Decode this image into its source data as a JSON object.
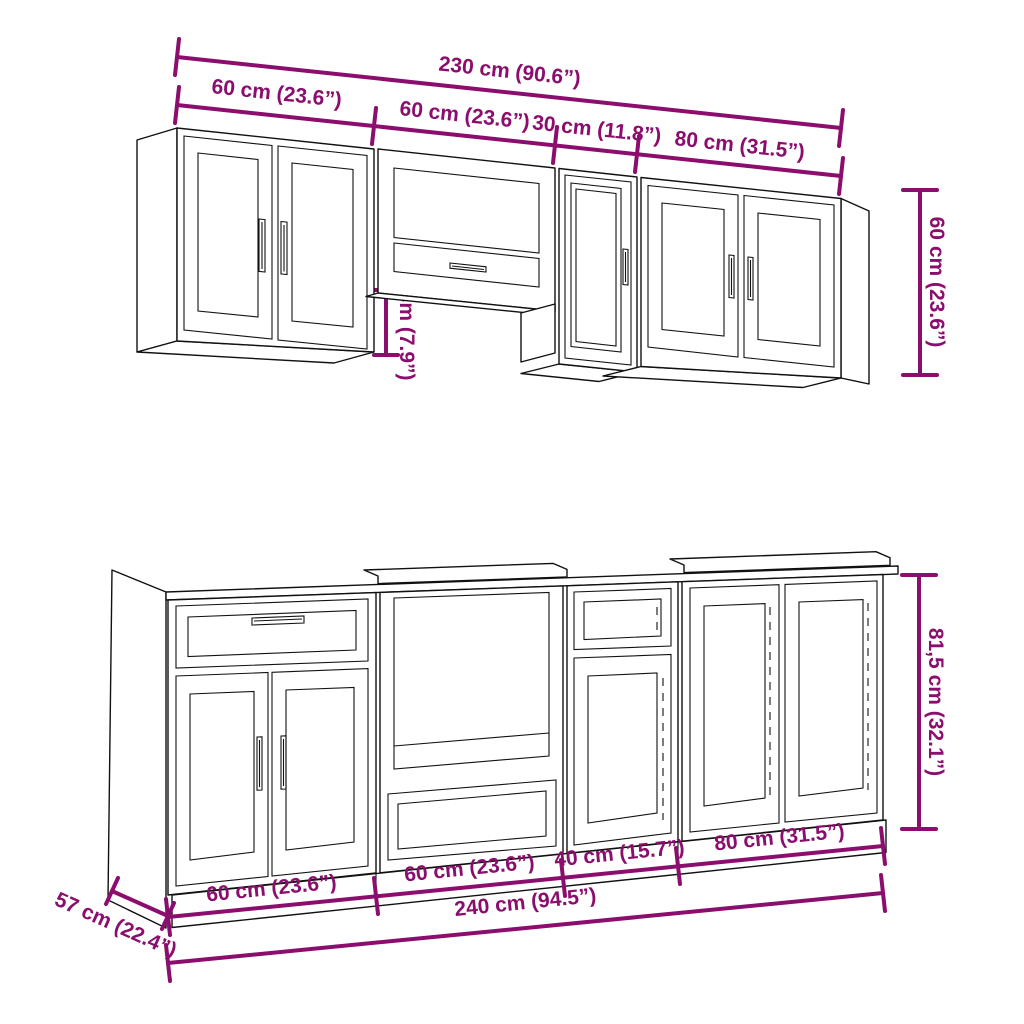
{
  "title": "Kitchen cabinet set dimension diagram",
  "colors": {
    "dimension": "#8B0D6D",
    "line": "#111111",
    "background": "#ffffff"
  },
  "wall_units": {
    "total_width_label": "230 cm (90.6”)",
    "segment_labels": [
      "60 cm (23.6”)",
      "60 cm (23.6”)",
      "30 cm (11.8”)",
      "80 cm (31.5”)"
    ],
    "height_label": "60 cm (23.6”)",
    "hood_gap_label": "20 cm (7.9”)"
  },
  "base_units": {
    "total_width_label": "240 cm (94.5”)",
    "segment_labels": [
      "60 cm (23.6”)",
      "60 cm (23.6”)",
      "40 cm (15.7”)",
      "80 cm (31.5”)"
    ],
    "height_label": "81,5 cm (32.1”)",
    "depth_label": "57 cm (22.4”)"
  }
}
